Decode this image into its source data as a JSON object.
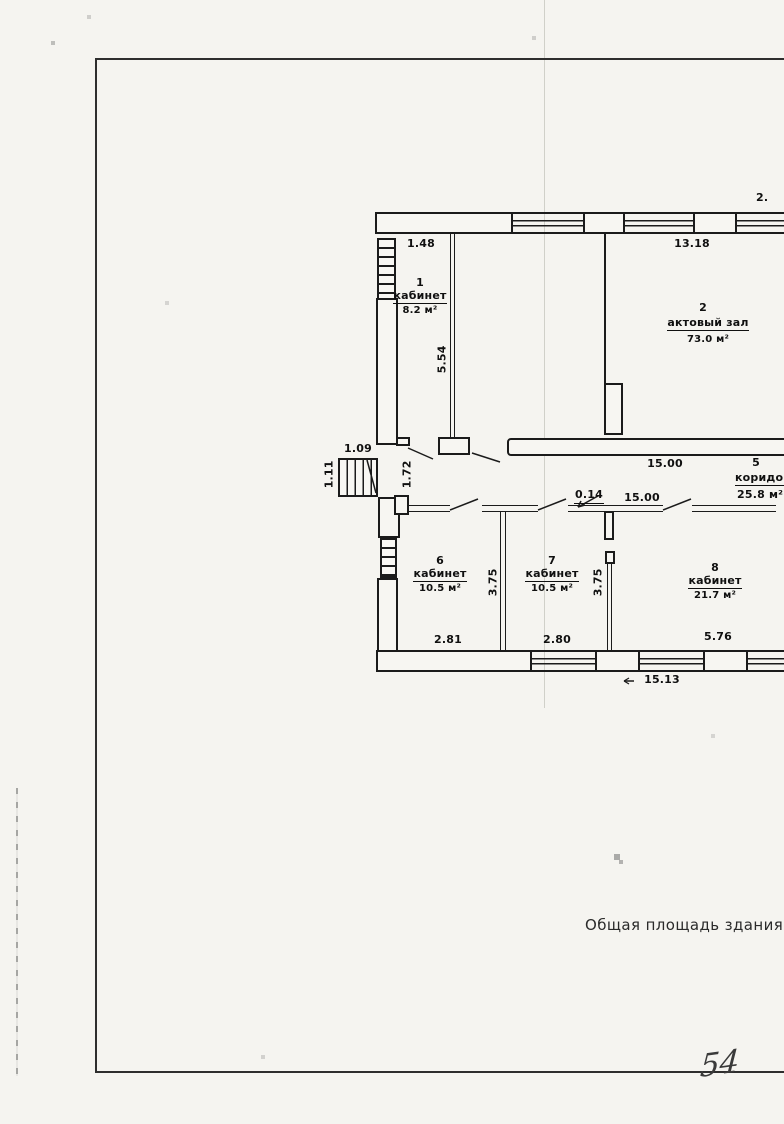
{
  "document": {
    "footer_text": "Общая площадь здания:  46",
    "page_number": "54"
  },
  "rooms": {
    "r1": {
      "number": "1",
      "name": "кабинет",
      "area": "8.2 м²"
    },
    "r2": {
      "number": "2",
      "name": "актовый зал",
      "area": "73.0 м²"
    },
    "r5": {
      "number": "5",
      "name": "коридор",
      "area": "25.8 м²"
    },
    "r6": {
      "number": "6",
      "name": "кабинет",
      "area": "10.5 м²"
    },
    "r7": {
      "number": "7",
      "name": "кабинет",
      "area": "10.5 м²"
    },
    "r8": {
      "number": "8",
      "name": "кабинет",
      "area": "21.7 м²"
    }
  },
  "dims": {
    "window_left": "1.48",
    "hall_top": "13.18",
    "top_right_partial": "2.",
    "room1_depth": "5.54",
    "corridor_len_top": "15.00",
    "corridor_len_mid": "15.00",
    "wall_thickness": "0.14",
    "stairs_width": "1.09",
    "stairs_depth": "1.11",
    "entry_width": "1.72",
    "room6_width": "2.81",
    "room7_width": "2.80",
    "room8_width": "5.76",
    "room6_depth": "3.75",
    "room7_depth": "3.75",
    "bottom_total": "15.13"
  }
}
